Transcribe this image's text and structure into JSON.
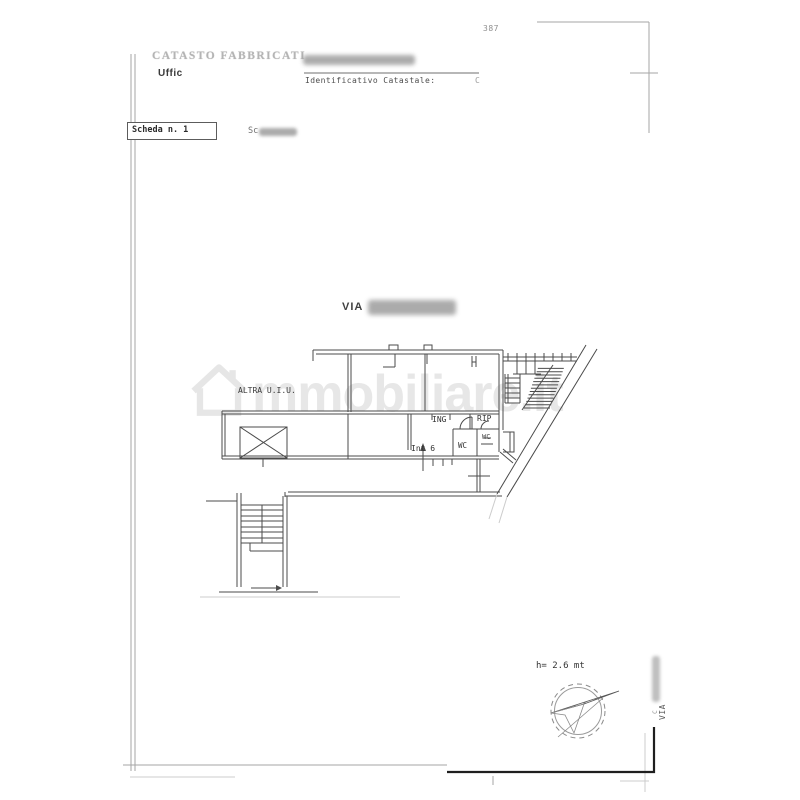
{
  "header": {
    "registry_title": "CATASTO FABBRICATI",
    "office_label": "Uffic",
    "identifier_label": "Identificativo Catastale:",
    "identifier_value_fragment": "C",
    "sheet_number": "387"
  },
  "sheet_bar": {
    "sheet_label": "Scheda n. 1",
    "scale_fragment": "Sc"
  },
  "plan": {
    "street_label": "VIA",
    "other_unit_label": "ALTRA U.I.U.",
    "room_entrance": "ING",
    "room_storage": "RIP",
    "room_wc_main": "WC",
    "room_wc_small": "WC",
    "unit_number": "Int 6",
    "height_note": "h= 2.6 mt"
  },
  "side_margin": {
    "street_label_small": "C",
    "street_label": "VIA"
  },
  "watermark": {
    "brand_text": "mmobiliare.it",
    "icon": "house-icon"
  },
  "colors": {
    "plan_line": "#4b4b4b",
    "frame_line": "#a3a3a3",
    "bold_frame": "#1f1f1f",
    "watermark": "#e7e7e7",
    "redaction": "#949494",
    "ink": "#333333"
  }
}
